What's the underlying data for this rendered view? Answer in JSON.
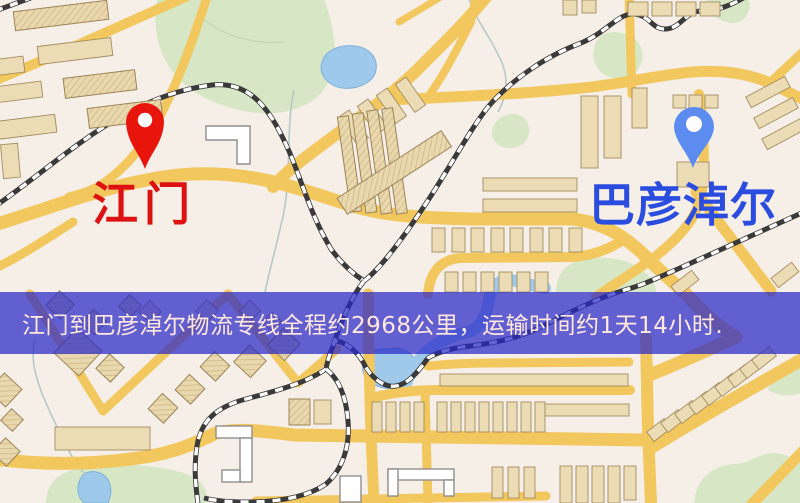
{
  "banner": {
    "text": "江门到巴彦淖尔物流专线全程约2968公里，运输时间约1天14小时."
  },
  "markers": {
    "origin": {
      "name": "江门",
      "label_color": "#dd1111",
      "pin_color": "#e8150d"
    },
    "destination": {
      "name": "巴彦淖尔",
      "label_color": "#2a4de0",
      "pin_color": "#5c8cf0"
    }
  },
  "route": {
    "distance_km": 2968,
    "duration_days": 1,
    "duration_hours": 14
  },
  "map_colors": {
    "background": "#f6efe8",
    "road": "#f2c75e",
    "water": "#9ec9ea",
    "park": "#d7e7c5",
    "building": "#ecdcb6",
    "railway": "#3a3a3a",
    "banner_overlay": "rgba(40,40,200,0.72)",
    "banner_text": "#ffe8df"
  }
}
